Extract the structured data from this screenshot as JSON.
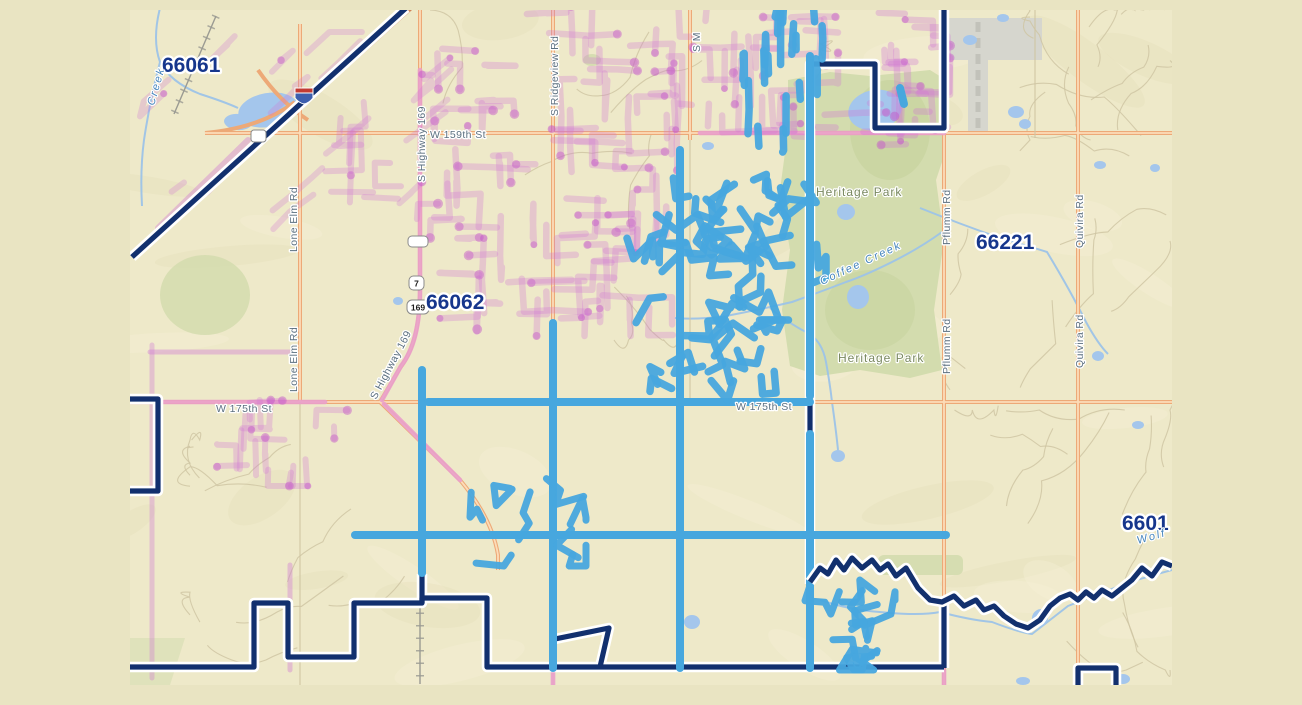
{
  "zip_labels": {
    "nw": "66061",
    "west": "66062",
    "east": "66221",
    "southeast": "6601"
  },
  "road_labels": {
    "w_159th": "W 159th St",
    "w_175th": "W 175th St",
    "s_ridgeview": "S Ridgeview Rd",
    "s_m": "S M",
    "lone_elm": "Lone Elm Rd",
    "s_highway_169": "S Highway 169",
    "pflumm": "Pflumm Rd",
    "quivira": "Quivira Rd"
  },
  "place_labels": {
    "heritage_park": "Heritage Park"
  },
  "water_labels": {
    "coffee_creek": "Coffee Creek",
    "creek": "Creek",
    "wolf": "Wolf"
  },
  "shields": {
    "route_7": "7",
    "route_169": "169"
  },
  "colors": {
    "page_background": "#e9e4c2",
    "map_base": "#eee9c9",
    "boundary_navy": "#12306e",
    "route_cyan": "#47a7de",
    "route_purple": "#cf77d4",
    "route_purple_dot": "#c455c8",
    "road_orange": "#eda977",
    "road_orange_core": "#fcdcb8",
    "road_pink": "#e99fca",
    "interstate_brown": "#cf8257",
    "park_green": "#d3dcae",
    "water_blue": "#a4c6ec",
    "creek_blue": "#9cc3e8",
    "airport_gray": "#d6d6ce",
    "zip_label": "#16368c",
    "road_label": "#5c7080",
    "park_label": "#7a8960",
    "creek_label": "#4585bd",
    "minor_road": "#cfc5a3",
    "terrain_shade": "#dfd4ab",
    "railroad_gray": "#9a9a92"
  }
}
